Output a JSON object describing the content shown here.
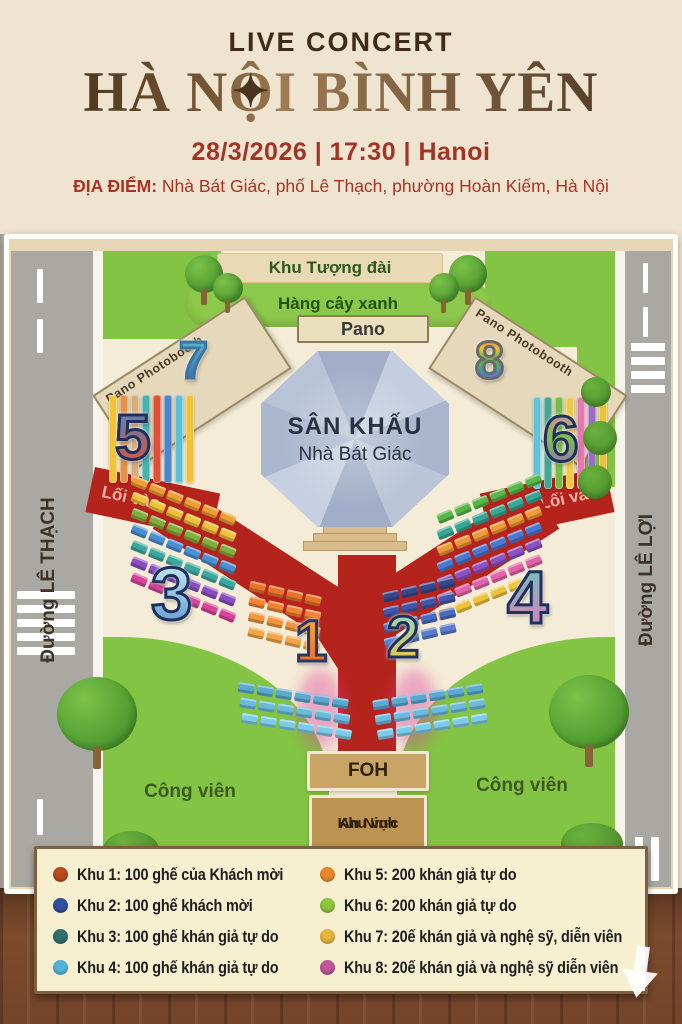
{
  "header": {
    "event_type": "LIVE CONCERT",
    "title": "HÀ NỘI BÌNH YÊN",
    "title_pre": "HÀ N",
    "title_o": "Ộ",
    "title_post": "I BÌNH YÊN",
    "star_glyph": "✦",
    "datetime": "28/3/2026 | 17:30 | Hanoi",
    "venue_label": "ĐỊA ĐIỂM:",
    "venue_text": " Nhà Bát Giác, phố Lê Thạch, phường Hoàn Kiếm, Hà Nội"
  },
  "map": {
    "monument_label": "Khu Tượng đài",
    "tree_row_label": "Hàng cây xanh",
    "pano_label": "Pano",
    "photobooth_label": "Pano Photobooth",
    "stage_line1": "SÂN KHẤU",
    "stage_line2": "Nhà Bát Giác",
    "entrance_label": "Lối vào",
    "street_left": "Đường LÊ THẠCH",
    "street_right": "Đường LÊ LỢI",
    "park_label": "Công viên",
    "foh_label": "FOH",
    "security_line1": "Khu vực",
    "security_line2": "An Ninh",
    "numbers": {
      "z1": "1",
      "z2": "2",
      "z3": "3",
      "z4": "4",
      "z5": "5",
      "z6": "6",
      "z7": "7",
      "z8": "8"
    },
    "seating": {
      "zone1_rows": [
        "#e8742b",
        "#f08433",
        "#f0953d",
        "#f2a648"
      ],
      "zone2_rows": [
        "#37478e",
        "#4156a8",
        "#4a69c0",
        "#5a7ccc"
      ],
      "zone3_rows": [
        "#ee9f33",
        "#eec33b",
        "#7fae3c",
        "#4a8fd2",
        "#3aa89e",
        "#8a4ec0",
        "#d8439c"
      ],
      "zone4_rows": [
        "#57b747",
        "#37a694",
        "#ef9b37",
        "#4a78d0",
        "#8a52c2",
        "#e263aa",
        "#eec33b"
      ],
      "arc_rows": [
        "#5aa9d2",
        "#6cbade",
        "#7ecbe8"
      ],
      "zone5_bars": [
        "#f2c335",
        "#e4924a",
        "#d9ad79",
        "#43b3b3",
        "#df4f3a",
        "#4a86cc",
        "#5cc0dd",
        "#f2c335"
      ],
      "zone6_bars": [
        "#64c2d8",
        "#41a795",
        "#76bd46",
        "#eecb43",
        "#e678b2",
        "#9a6cc8",
        "#ecc23a"
      ]
    }
  },
  "legend": {
    "items": [
      {
        "color": "#b9491f",
        "label": "Khu 1: 100 ghế của Khách mời"
      },
      {
        "color": "#30509e",
        "label": "Khu 2: 100 ghế khách mời"
      },
      {
        "color": "#2f6f6f",
        "label": "Khu 3: 100 ghế khán giả tự do"
      },
      {
        "color": "#51b5d8",
        "label": "Khu 4: 100 ghế khán giả tự do"
      },
      {
        "color": "#e78a2e",
        "label": "Khu 5: 200 khán giả tự do"
      },
      {
        "color": "#8dc63f",
        "label": "Khu 6: 200 khán giả tự do"
      },
      {
        "color": "#eab440",
        "label": "Khu 7: 20ế khán giả và nghệ sỹ, diễn viên"
      },
      {
        "color": "#c0569c",
        "label": "Khu 8: 20ế khán giả và nghệ sỹ diễn viên"
      }
    ]
  }
}
